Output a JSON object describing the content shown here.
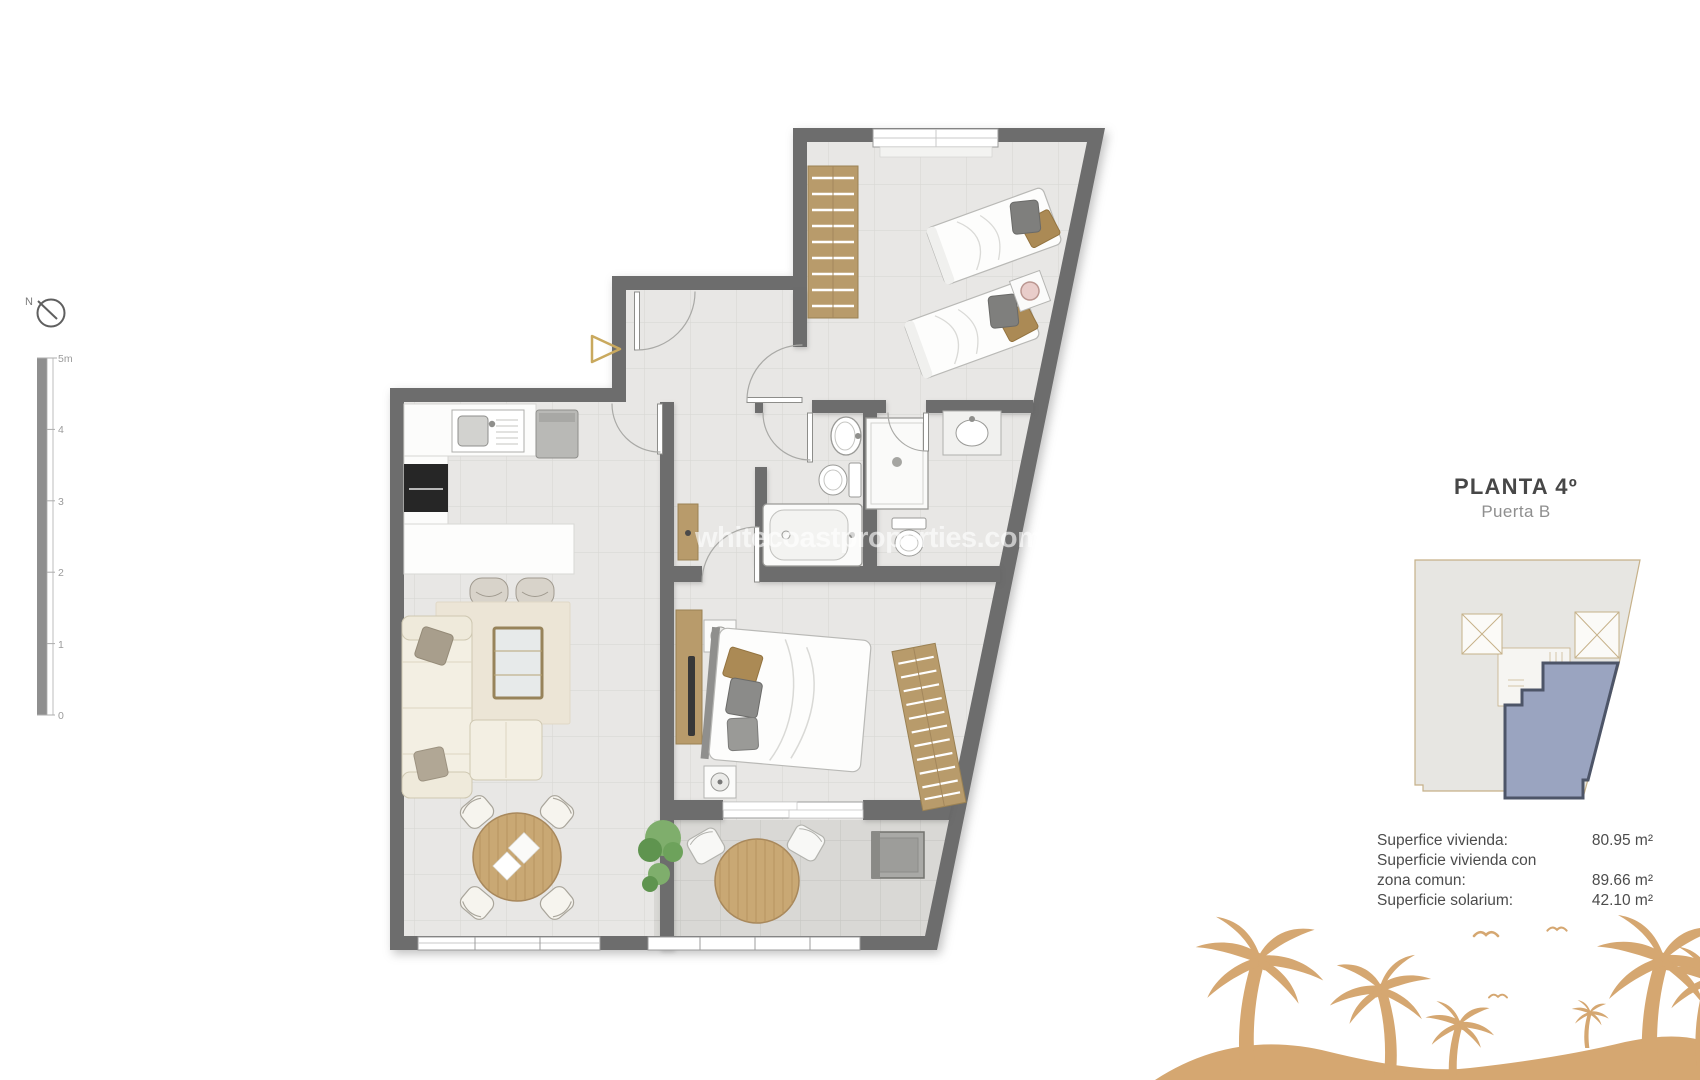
{
  "header": {
    "title": "PLANTA 4º",
    "subtitle": "Puerta B"
  },
  "watermark": "whitecoastproperties.com",
  "areas": {
    "line1_label": "Superfice vivienda:",
    "line1_value": "80.95 m²",
    "line2_label": "Superficie vivienda con",
    "line3_label": "zona comun:",
    "line3_value": "89.66 m²",
    "line4_label": "Superficie solarium:",
    "line4_value": "42.10 m²"
  },
  "compass": {
    "label": "N"
  },
  "scale_bar": {
    "labels": [
      "5m",
      "4",
      "3",
      "2",
      "1",
      "0"
    ]
  },
  "key_plan": {
    "highlight_color": "#9aa4c0",
    "outline_color": "#4d5568",
    "building_stroke": "#c6b189"
  },
  "colors": {
    "wall": "#6d6d6d",
    "wood": "#b89b6b",
    "palm": "#d5a771",
    "floor": "#e8e7e5",
    "unit_blue": "#9aa4c0"
  }
}
